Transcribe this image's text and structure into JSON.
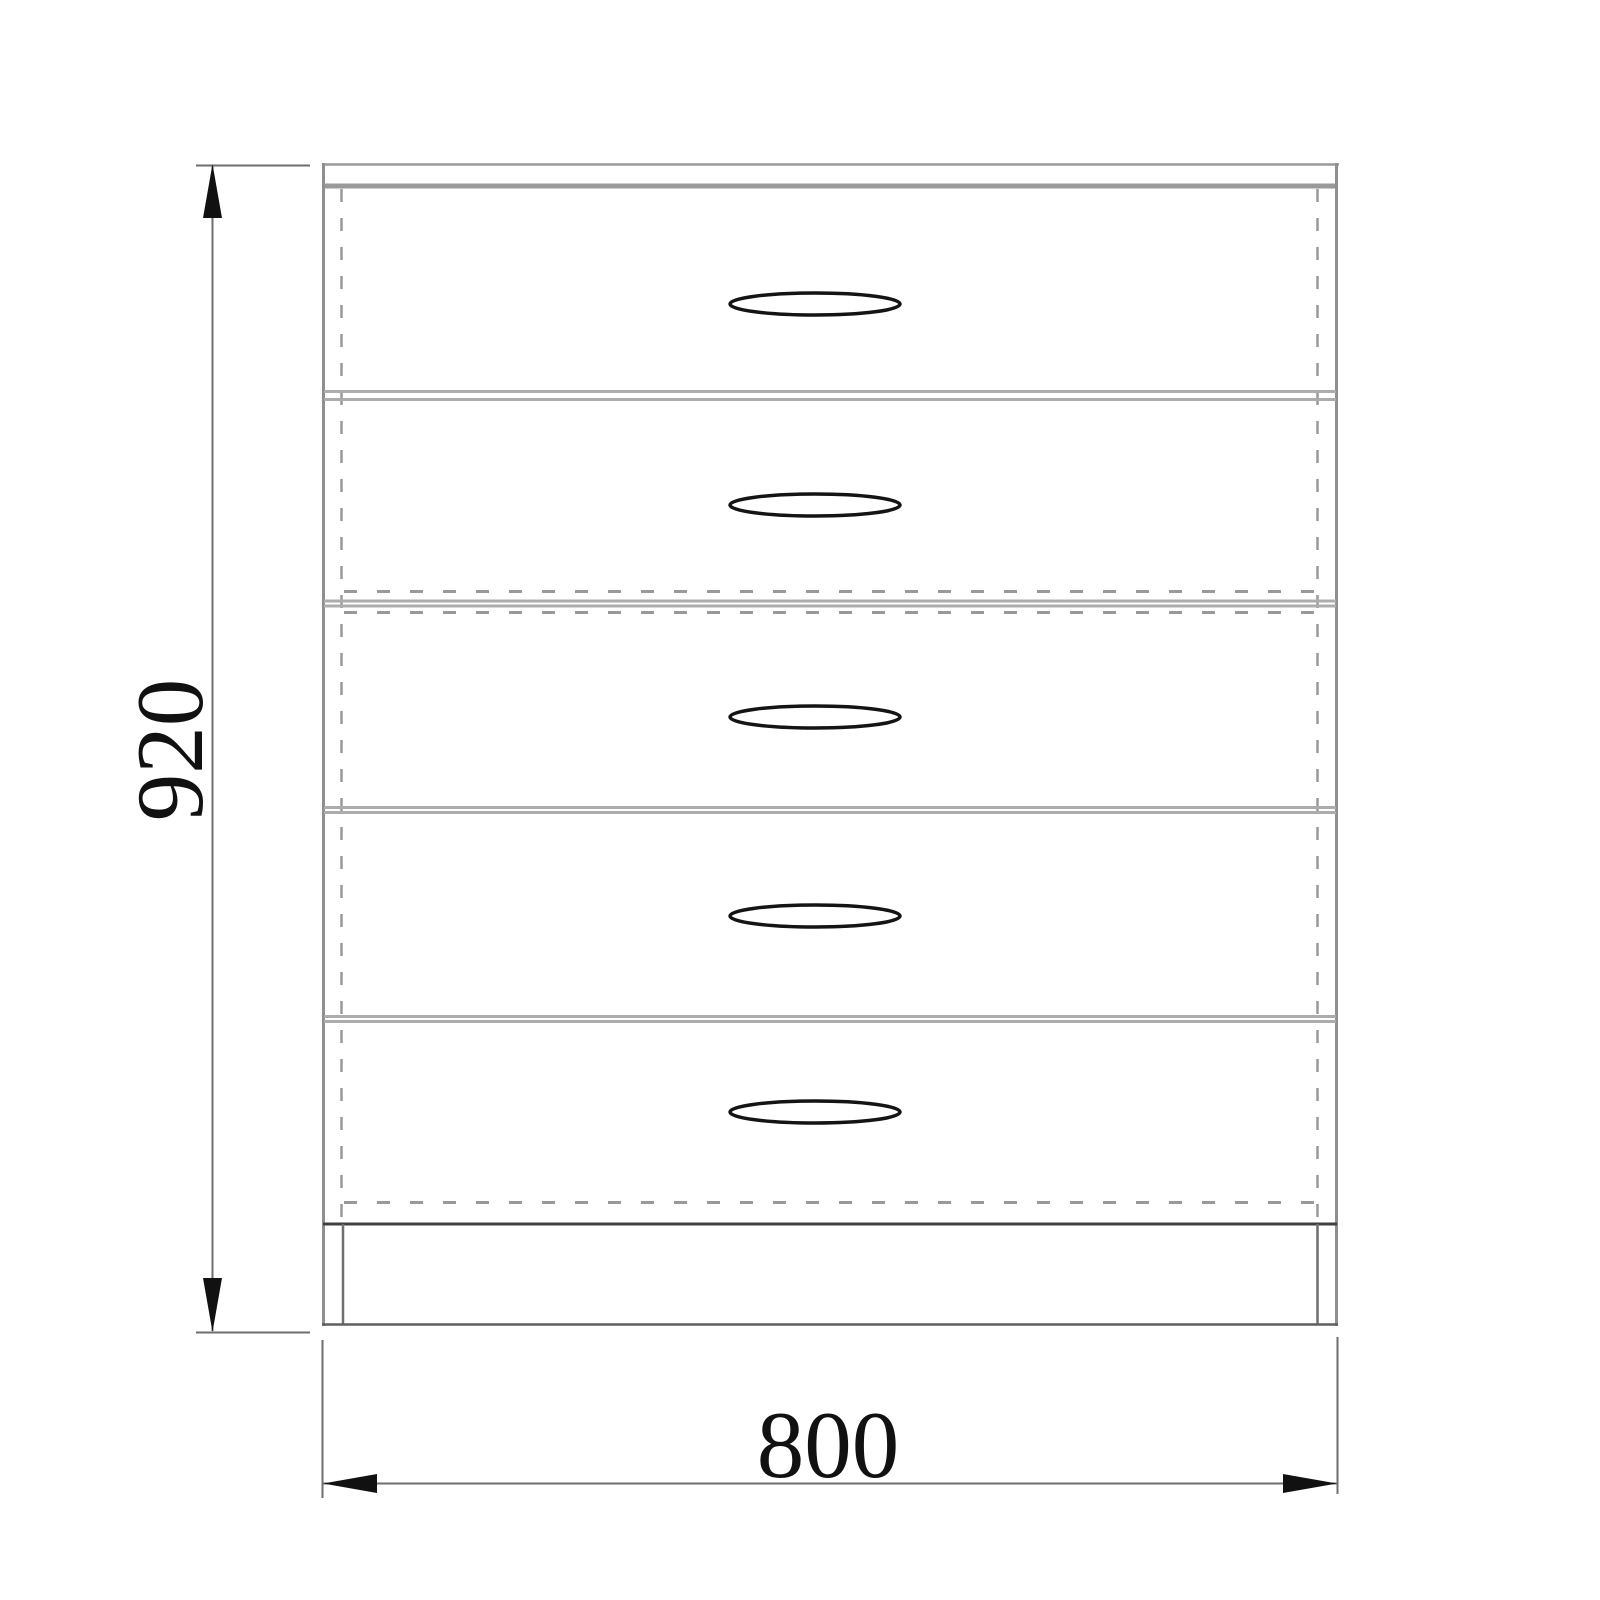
{
  "drawing": {
    "object": "chest-of-drawers",
    "view": "front-elevation",
    "drawer_count": 5,
    "height_dimension": "920",
    "width_dimension": "800"
  },
  "colors": {
    "background": "#ffffff",
    "outline_gray": "#8f8f8f",
    "top_panel_gray": "#9a9a9a",
    "separator_gray": "#acacac",
    "hidden_edge_gray": "#999999",
    "dark_edge": "#3f3f3f",
    "dimension_line": "#6e6e6e",
    "ink": "#111111"
  }
}
